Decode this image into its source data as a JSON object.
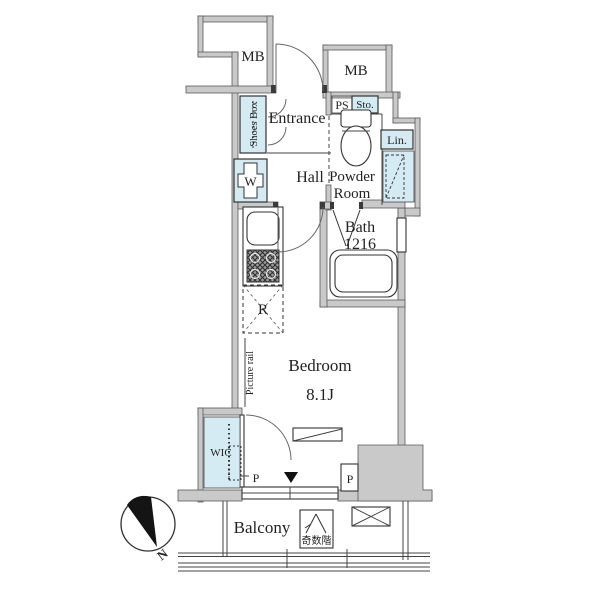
{
  "page_title": "Apartment floor plan",
  "colors": {
    "wall_fill": "#c9c9c9",
    "wall_stroke": "#5a5a5a",
    "line": "#333333",
    "fixture_blue": "#d5ebf3",
    "compass_needle": "#141414"
  },
  "labels": {
    "mb_left": "MB",
    "mb_right": "MB",
    "entrance": "Entrance",
    "shoes_box": "Shoes Box",
    "ps": "PS",
    "sto": "Sto.",
    "lin": "Lin.",
    "powder_line1": "Powder",
    "powder_line2": "Room",
    "hall": "Hall",
    "washer": "W",
    "bath_name": "Bath",
    "bath_size": "1216",
    "fridge": "R",
    "picture_rail": "Picture rail",
    "bedroom": "Bedroom",
    "bedroom_size": "8.1J",
    "wic": "WIC",
    "p_left": "P",
    "p_right": "P",
    "balcony": "Balcony",
    "stair_note": "奇数階",
    "north": "N"
  }
}
